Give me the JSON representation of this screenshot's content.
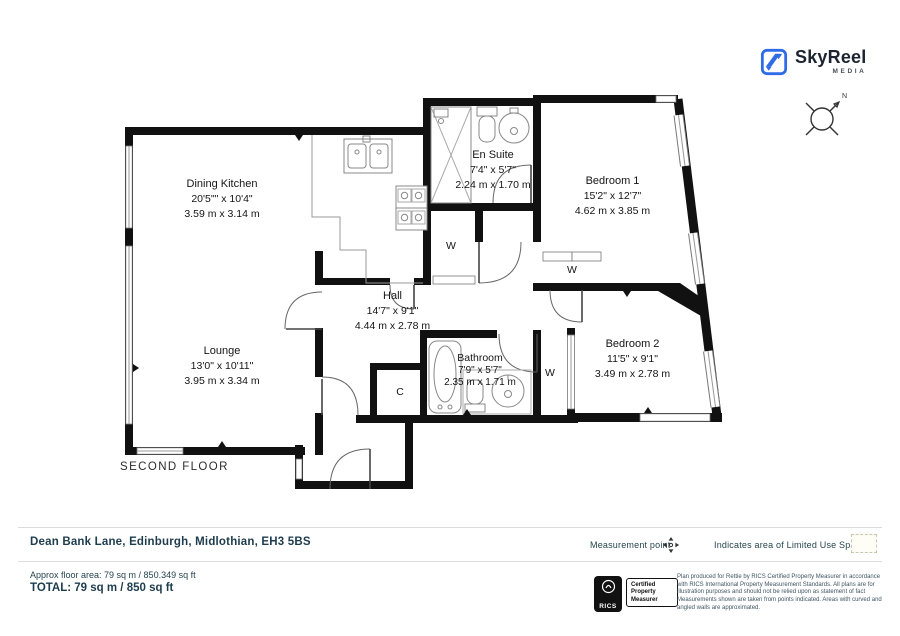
{
  "branding": {
    "name": "SkyReel",
    "tagline": "MEDIA"
  },
  "compass": {
    "north_label": "N"
  },
  "floor_label": "SECOND FLOOR",
  "rooms": {
    "dining_kitchen": {
      "name": "Dining Kitchen",
      "imperial": "20'5\"\" x 10'4\"",
      "metric": "3.59 m x 3.14 m"
    },
    "lounge": {
      "name": "Lounge",
      "imperial": "13'0\" x 10'11\"",
      "metric": "3.95 m x 3.34 m"
    },
    "hall": {
      "name": "Hall",
      "imperial": "14'7\" x 9'1\"",
      "metric": "4.44 m x 2.78 m"
    },
    "en_suite": {
      "name": "En Suite",
      "imperial": "7'4\" x 5'7\"",
      "metric": "2.24 m x 1.70 m"
    },
    "bedroom_1": {
      "name": "Bedroom 1",
      "imperial": "15'2\" x 12'7\"",
      "metric": "4.62 m x 3.85 m"
    },
    "bedroom_2": {
      "name": "Bedroom 2",
      "imperial": "11'5\" x 9'1\"",
      "metric": "3.49 m x 2.78 m"
    },
    "bathroom": {
      "name": "Bathroom",
      "imperial": "7'9\" x 5'7\"",
      "metric": "2.35 m x 1.71 m"
    }
  },
  "closets": {
    "wardrobe_ensuite": "W",
    "wardrobe_bedroom1": "W",
    "wardrobe_bedroom2": "W",
    "cupboard": "C"
  },
  "address_bar": {
    "address": "Dean Bank Lane, Edinburgh, Midlothian, EH3 5BS",
    "measurement_point_label": "Measurement point",
    "limited_use_label": "Indicates area of  Limited Use Space"
  },
  "area_summary": {
    "approx": "Approx floor area: 79 sq m / 850.349 sq ft",
    "total": "TOTAL: 79 sq m / 850 sq ft"
  },
  "certification": {
    "org": "RICS",
    "badge_line_1": "Certified",
    "badge_line_2": "Property",
    "badge_line_3": "Measurer",
    "disclaimer": "Plan produced for Rettie by RICS Certified Property Measurer in accordance with RICS International Property  Measurement Standards.  All plans are for illustration purposes and should not be relied upon as statement of fact Measurements shown are taken from points indicated.  Areas with curved and angled walls are approximated."
  },
  "colors": {
    "accent_blue": "#2e6be6",
    "text_navy": "#1d3c4d",
    "wall_black": "#111111"
  }
}
